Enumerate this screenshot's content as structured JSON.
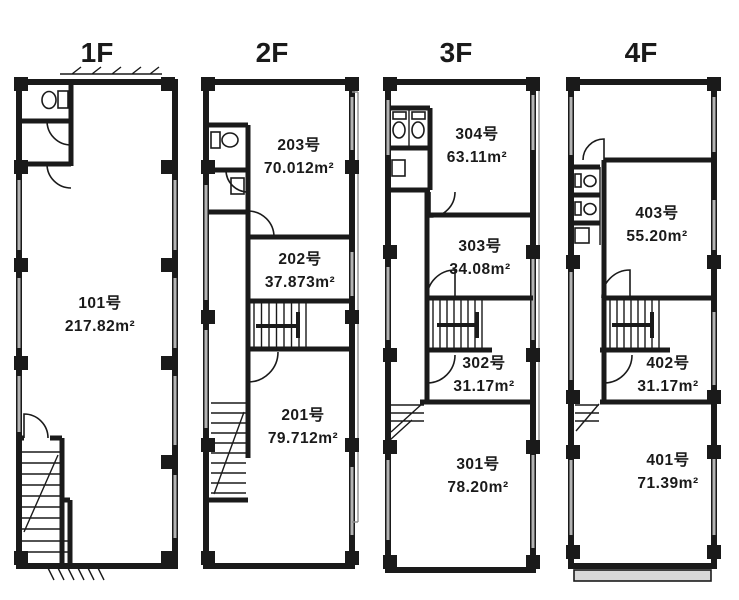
{
  "document": {
    "type": "building-floor-plan"
  },
  "colors": {
    "line": "#1a1a1a",
    "background": "#ffffff",
    "window_gray": "#b3b3b3",
    "balcony_fill": "#d8d8d8"
  },
  "floors": [
    {
      "id": "1f",
      "title": "1F",
      "rooms": [
        {
          "number": "101号",
          "area": "217.82m²"
        }
      ]
    },
    {
      "id": "2f",
      "title": "2F",
      "rooms": [
        {
          "number": "203号",
          "area": "70.012m²"
        },
        {
          "number": "202号",
          "area": "37.873m²"
        },
        {
          "number": "201号",
          "area": "79.712m²"
        }
      ]
    },
    {
      "id": "3f",
      "title": "3F",
      "rooms": [
        {
          "number": "304号",
          "area": "63.11m²"
        },
        {
          "number": "303号",
          "area": "34.08m²"
        },
        {
          "number": "302号",
          "area": "31.17m²"
        },
        {
          "number": "301号",
          "area": "78.20m²"
        }
      ]
    },
    {
      "id": "4f",
      "title": "4F",
      "rooms": [
        {
          "number": "403号",
          "area": "55.20m²"
        },
        {
          "number": "402号",
          "area": "31.17m²"
        },
        {
          "number": "401号",
          "area": "71.39m²"
        }
      ]
    }
  ]
}
